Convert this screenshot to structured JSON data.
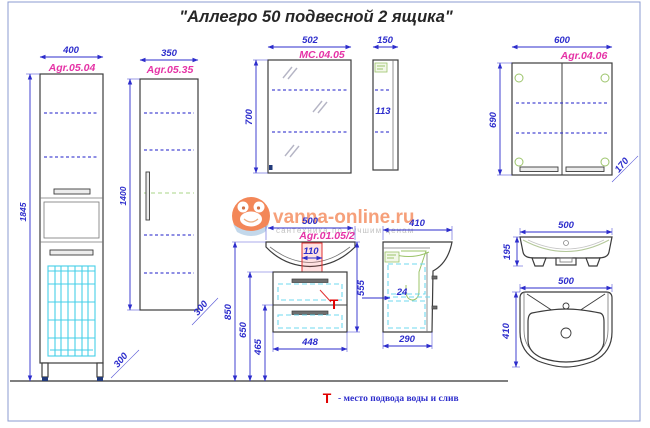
{
  "title": "\"Аллегро 50 подвесной 2 ящика\"",
  "colors": {
    "dimension_blue": "#2d2dcc",
    "label_pink": "#e533a6",
    "basket_cyan": "#45cfe8",
    "accent_green": "#9cc46a",
    "marker_red": "#e00000",
    "watermark_orange": "#f2733c",
    "border_blue": "#8b9bd0"
  },
  "tall_cabinet": {
    "code": "Agr.05.04",
    "width": "400",
    "height": "1845",
    "depth": "300"
  },
  "mid_cabinet": {
    "code": "Agr.05.35",
    "width": "350",
    "height": "1400",
    "depth": "300"
  },
  "mirror_cabinet": {
    "code": "MC.04.05",
    "width": "502",
    "height": "700",
    "side_depth": "150",
    "side_inner": "113"
  },
  "wall_cabinet": {
    "code": "Agr.04.06",
    "width": "600",
    "height": "690",
    "depth": "170"
  },
  "vanity": {
    "code": "Agr.01.05/2",
    "width": "500",
    "sink_cutout": "110",
    "height": "555",
    "drawer_width": "448",
    "mount_height": "850",
    "body_top_height": "650",
    "divider_height": "465"
  },
  "vanity_side": {
    "depth_top": "410",
    "depth_bottom": "290",
    "offset": "24"
  },
  "sink_front": {
    "width": "500",
    "height": "195"
  },
  "sink_top": {
    "width": "500",
    "depth": "410"
  },
  "watermark": {
    "site": "vanna-online.ru",
    "tagline": "сантехника по лучшим ценам"
  },
  "note": {
    "marker": "T",
    "text": "- место подвода воды и слив"
  }
}
